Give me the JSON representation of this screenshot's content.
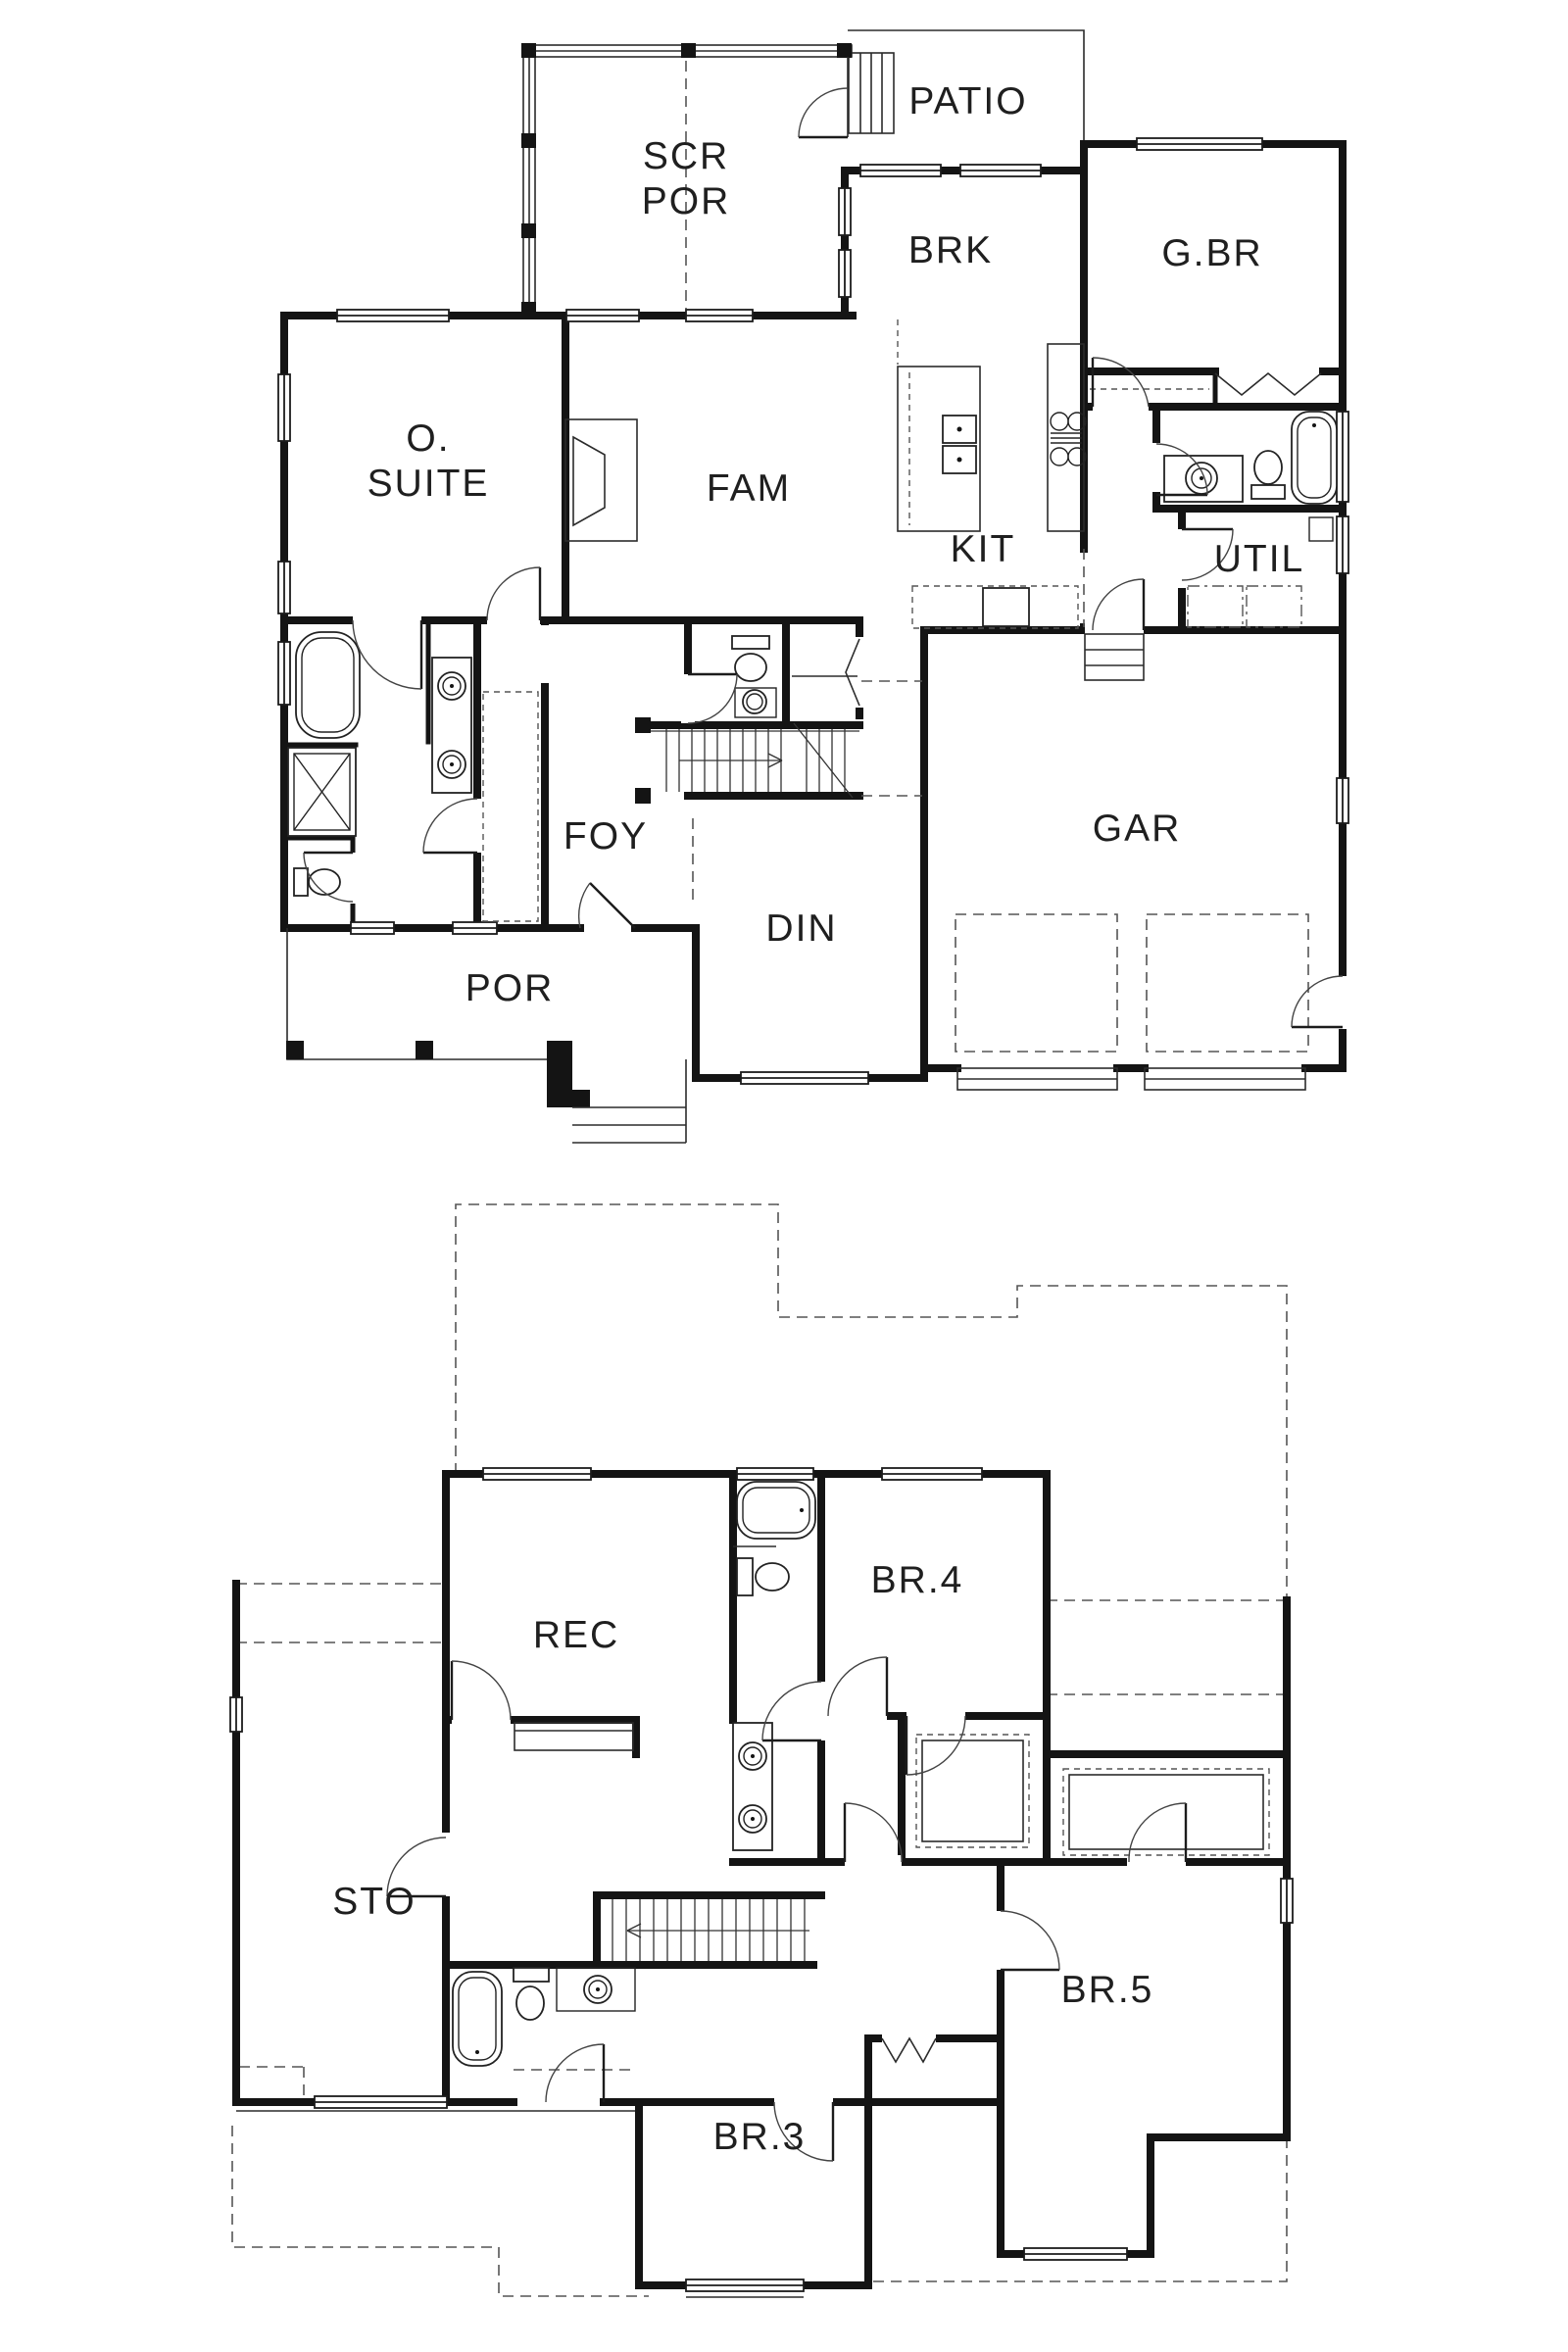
{
  "page": {
    "background": "#ffffff",
    "ink": "#141414"
  },
  "first_floor": {
    "rooms": {
      "scr_por": [
        "SCR",
        "POR"
      ],
      "patio": "PATIO",
      "brk": "BRK",
      "gbr": "G.BR",
      "osuite": [
        "O.",
        "SUITE"
      ],
      "fam": "FAM",
      "kit": "KIT",
      "util": "UTIL",
      "foy": "FOY",
      "din": "DIN",
      "gar": "GAR",
      "por": "POR"
    }
  },
  "second_floor": {
    "rooms": {
      "rec": "REC",
      "br4": "BR.4",
      "sto": "STO",
      "br5": "BR.5",
      "br3": "BR.3"
    }
  }
}
